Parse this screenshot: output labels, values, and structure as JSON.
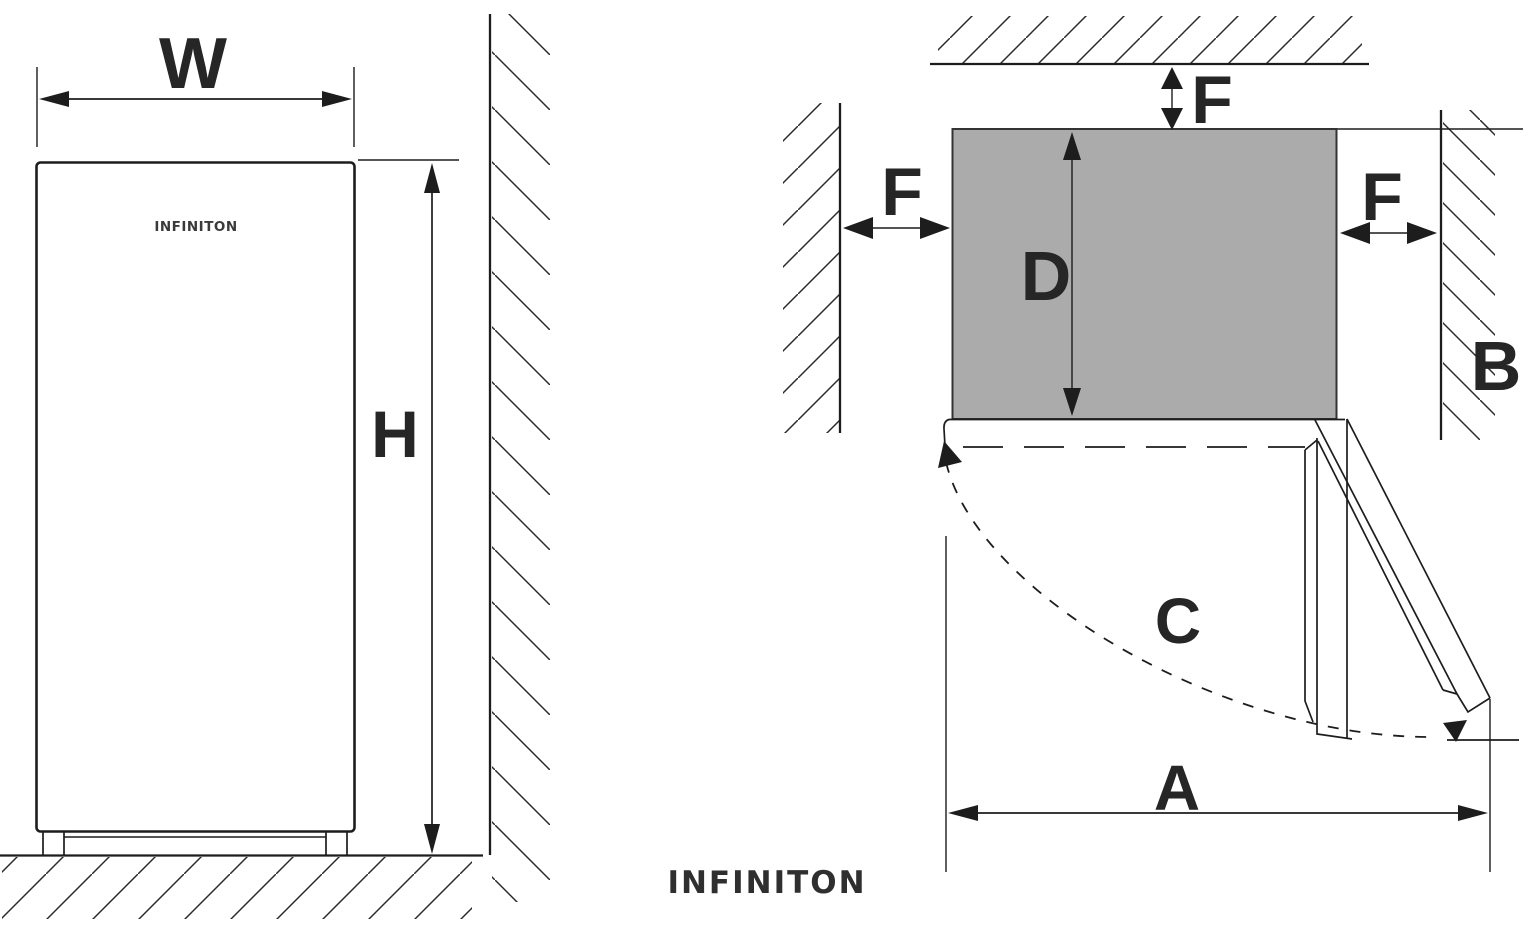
{
  "front_view": {
    "dim_width_label": "W",
    "dim_height_label": "H",
    "appliance_brand": "INFINITON"
  },
  "top_view": {
    "clearance_top_label": "F",
    "clearance_left_label": "F",
    "clearance_right_label": "F",
    "dim_depth_label": "D",
    "dim_wall_label": "B",
    "dim_swing_label": "C",
    "dim_total_label": "A"
  },
  "footer": {
    "brand_logo": "INFINITON"
  },
  "colors": {
    "line": "#1d1d1d",
    "label": "#262626",
    "cabinet_fill": "#ababab",
    "background": "#ffffff"
  }
}
